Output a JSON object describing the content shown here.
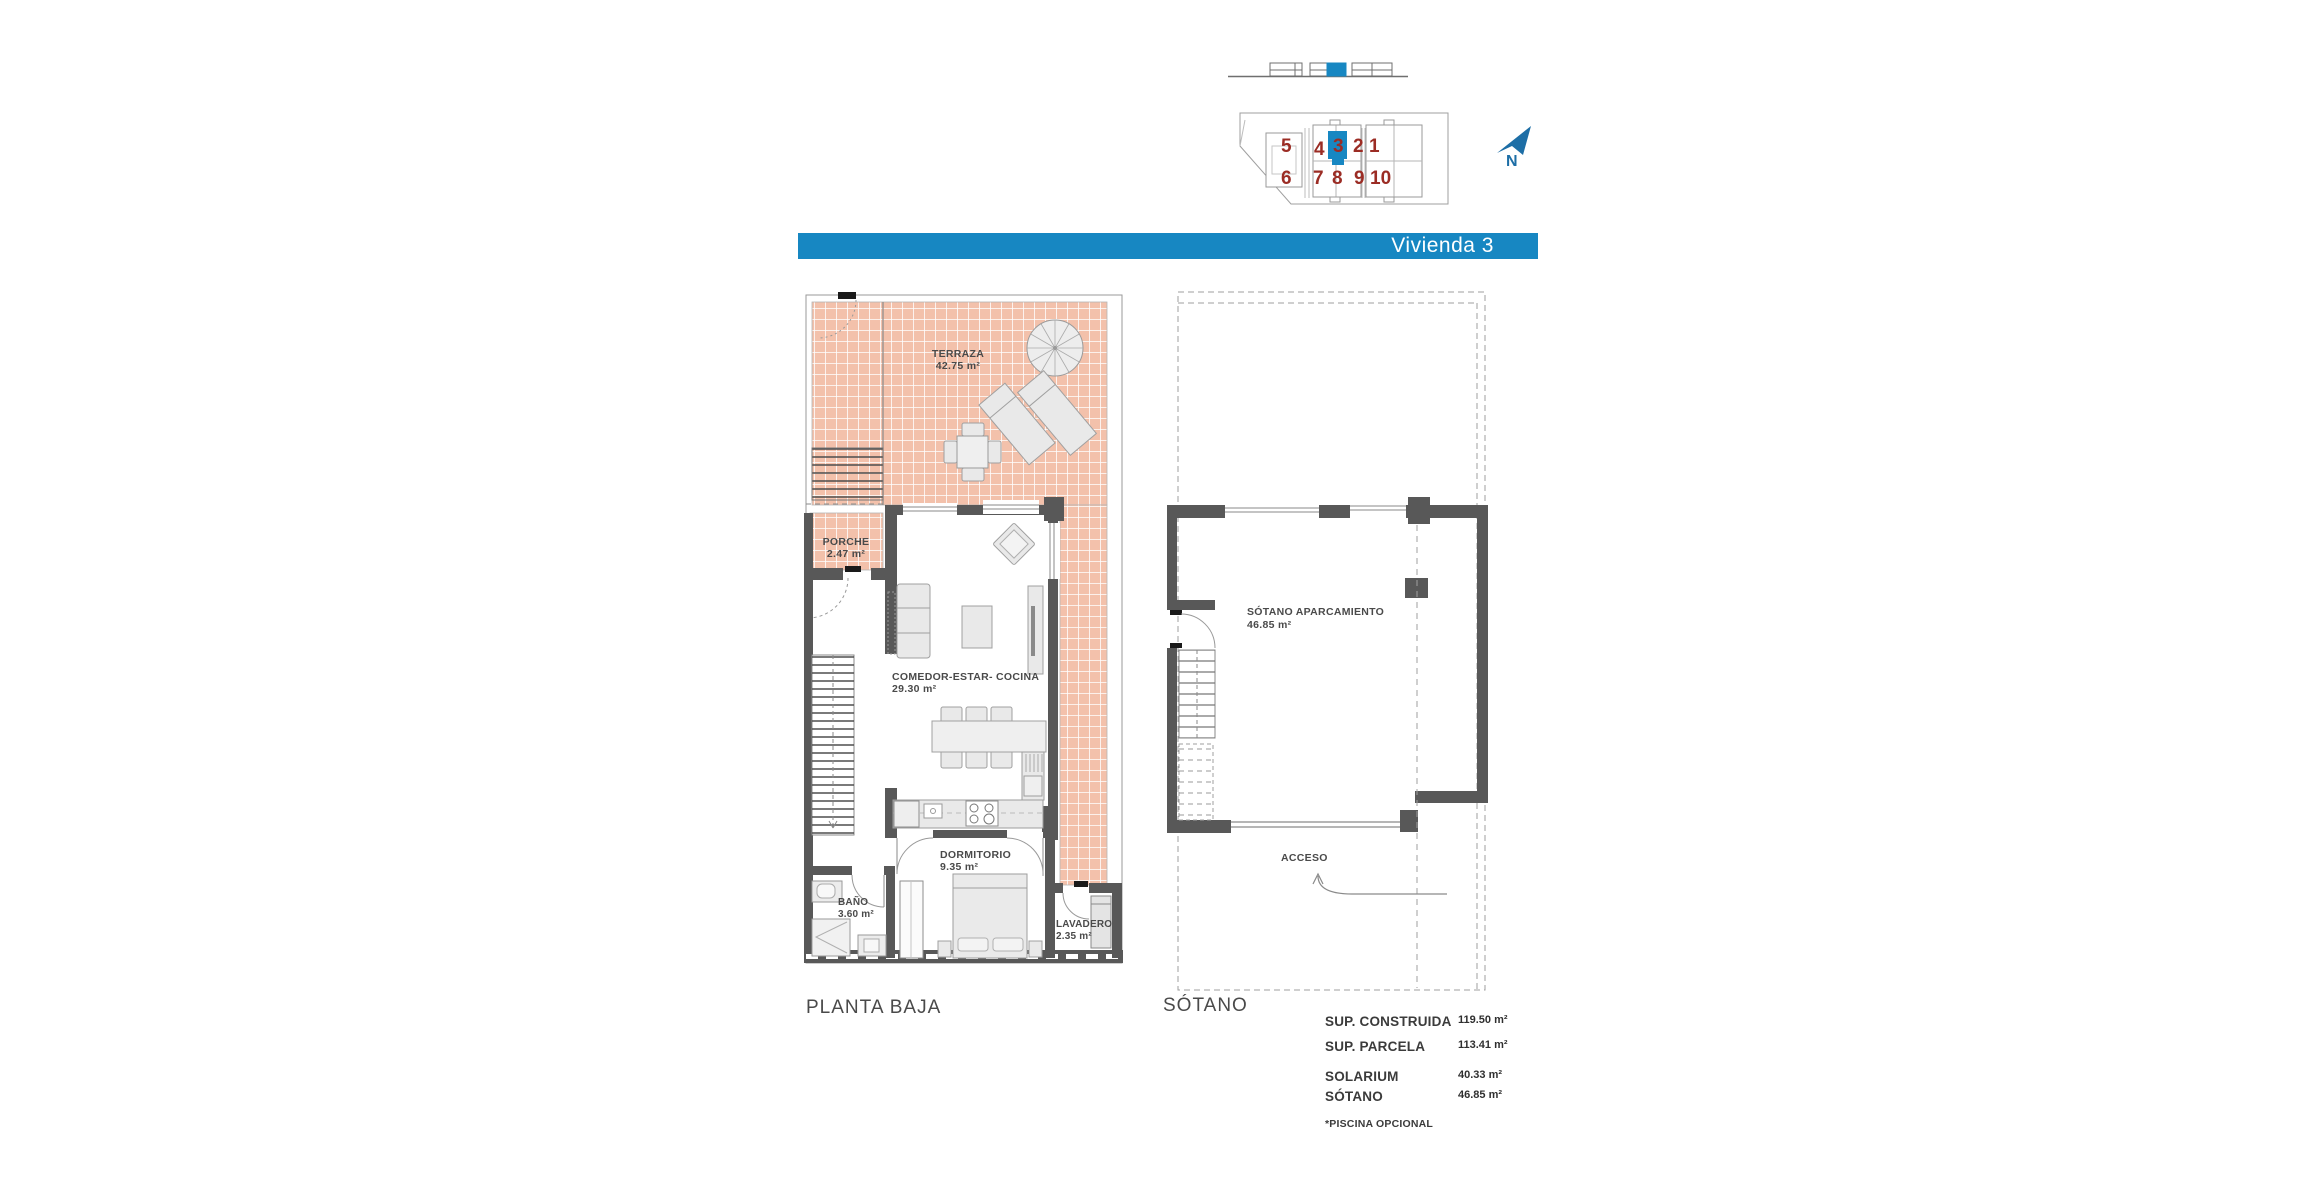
{
  "banner": {
    "label": "Vivienda 3",
    "color": "#1787c2"
  },
  "site_map": {
    "numbers_top": [
      "5",
      "4",
      "3",
      "2",
      "1"
    ],
    "numbers_bottom": [
      "6",
      "7",
      "8",
      "9",
      "10"
    ],
    "highlighted_unit": "3",
    "north_label": "N"
  },
  "ground_floor": {
    "title": "PLANTA BAJA",
    "rooms": {
      "terraza": {
        "name": "TERRAZA",
        "area": "42.75 m²"
      },
      "porche": {
        "name": "PORCHE",
        "area": "2.47 m²"
      },
      "salon": {
        "name": "COMEDOR-ESTAR- COCINA",
        "area": "29.30 m²"
      },
      "dormitorio": {
        "name": "DORMITORIO",
        "area": "9.35 m²"
      },
      "bano": {
        "name": "BAÑO",
        "area": "3.60 m²"
      },
      "lavadero": {
        "name": "LAVADERO",
        "area": "2.35 m²"
      }
    }
  },
  "basement": {
    "title": "SÓTANO",
    "room": {
      "name": "SÓTANO APARCAMIENTO",
      "area": "46.85 m²"
    },
    "access_label": "ACCESO"
  },
  "summary": {
    "row1": {
      "label": "SUP. CONSTRUIDA",
      "value": "119.50 m²"
    },
    "row2": {
      "label": "SUP. PARCELA",
      "value": "113.41 m²"
    },
    "row3": {
      "label": "SOLARIUM",
      "value": "40.33 m²"
    },
    "row4": {
      "label": "SÓTANO",
      "value": "46.85 m²"
    },
    "note": "*PISCINA OPCIONAL"
  },
  "colors": {
    "accent_blue": "#1787c2",
    "north_blue": "#1d6ea6",
    "unit_red": "#9b2c24",
    "tile_pink": "#f3c1ab",
    "wall_gray": "#585858"
  }
}
